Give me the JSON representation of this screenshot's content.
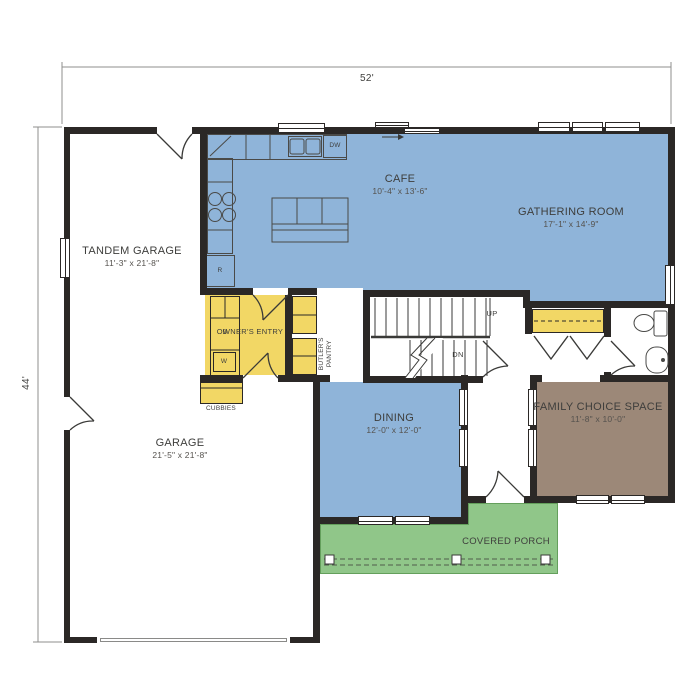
{
  "plan": {
    "overall_width_label": "52'",
    "overall_height_label": "44'"
  },
  "rooms": {
    "tandem_garage": {
      "name": "TANDEM GARAGE",
      "dims": "11'-3\" x 21'-8\""
    },
    "cafe": {
      "name": "CAFE",
      "dims": "10'-4\" x 13'-6\""
    },
    "gathering": {
      "name": "GATHERING ROOM",
      "dims": "17'-1\" x 14'-9\""
    },
    "owners_entry": {
      "name": "OWNER'S ENTRY"
    },
    "butlers_pantry": {
      "name": "BUTLER'S PANTRY"
    },
    "dining": {
      "name": "DINING",
      "dims": "12'-0\" x 12'-0\""
    },
    "garage": {
      "name": "GARAGE",
      "dims": "21'-5\" x 21'-8\""
    },
    "family_choice": {
      "name": "FAMILY CHOICE SPACE",
      "dims": "11'-8\" x 10'-0\""
    },
    "covered_porch": {
      "name": "COVERED PORCH"
    },
    "cubbies": {
      "name": "CUBBIES"
    }
  },
  "labels": {
    "up": "UP",
    "down": "DN",
    "dishwasher": "DW",
    "refrigerator": "R",
    "dryer": "D",
    "washer": "W"
  },
  "colors": {
    "living": "#8FB4D9",
    "utility": "#F2D765",
    "porch": "#90C689",
    "flex": "#9C8878",
    "wall": "#2B2826"
  }
}
